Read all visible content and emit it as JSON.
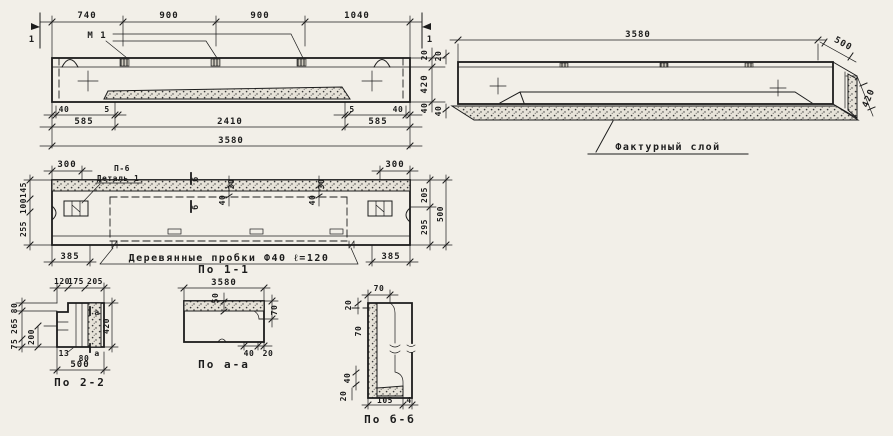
{
  "sheet": {
    "background": "#f2efe8",
    "ink": "#1c1c1c"
  },
  "elevation": {
    "section_mark_left": "1",
    "section_mark_right": "1",
    "anchor_label": "М 1",
    "dims_top": [
      "740",
      "900",
      "900",
      "1040"
    ],
    "dim_right_top": "20",
    "dim_right_main": "420",
    "dim_right_bottom": "40",
    "dims_small": [
      "40",
      "5",
      "5",
      "40"
    ],
    "dims_mid": [
      "585",
      "2410",
      "585"
    ],
    "dim_total": "3580"
  },
  "axonometric": {
    "dim_length": "3580",
    "dim_width": "500",
    "dim_height": "420",
    "dim_edge_top": "20",
    "dim_edge_bottom": "40",
    "label_textured_layer": "Фактурный слой"
  },
  "plan": {
    "dim_top_left": "300",
    "dim_top_right": "300",
    "label_series": "П-6",
    "label_detail": "Деталь 1",
    "section_letter_top": "б",
    "section_letter_bottom": "б",
    "dims_cut_1": [
      "30",
      "40"
    ],
    "dims_cut_2": [
      "30",
      "40"
    ],
    "dims_left": [
      "145",
      "100",
      "255"
    ],
    "dims_right": [
      "205",
      "295"
    ],
    "dim_right_total": "500",
    "dim_bottom_left": "385",
    "dim_bottom_right": "385",
    "note_plugs": "Деревянные пробки Ф40 ℓ=120"
  },
  "section_2_2": {
    "caption": "По 2-2",
    "dims_top": [
      "120",
      "175",
      "205"
    ],
    "dims_left": [
      "80",
      "265",
      "75"
    ],
    "dim_inner": "200",
    "dim_right": "420",
    "dim_small_1": "13",
    "dim_small_2": "80",
    "dim_bottom": "500",
    "cut_letter_top": "а",
    "cut_letter_bottom": "а"
  },
  "section_1_1": {
    "title": "По 1-1",
    "dim_length": "3580",
    "dim_layer": "50",
    "dim_step": "70",
    "dim_bottom_1": "40",
    "dim_bottom_2": "20",
    "caption": "По а-а"
  },
  "section_b_b": {
    "caption": "По б-б",
    "dim_top": "70",
    "dim_upper": "20",
    "dim_mid": "70",
    "dim_lower": "40",
    "dim_corner": "20",
    "dim_bottom_1": "105",
    "dim_bottom_2": "4"
  }
}
